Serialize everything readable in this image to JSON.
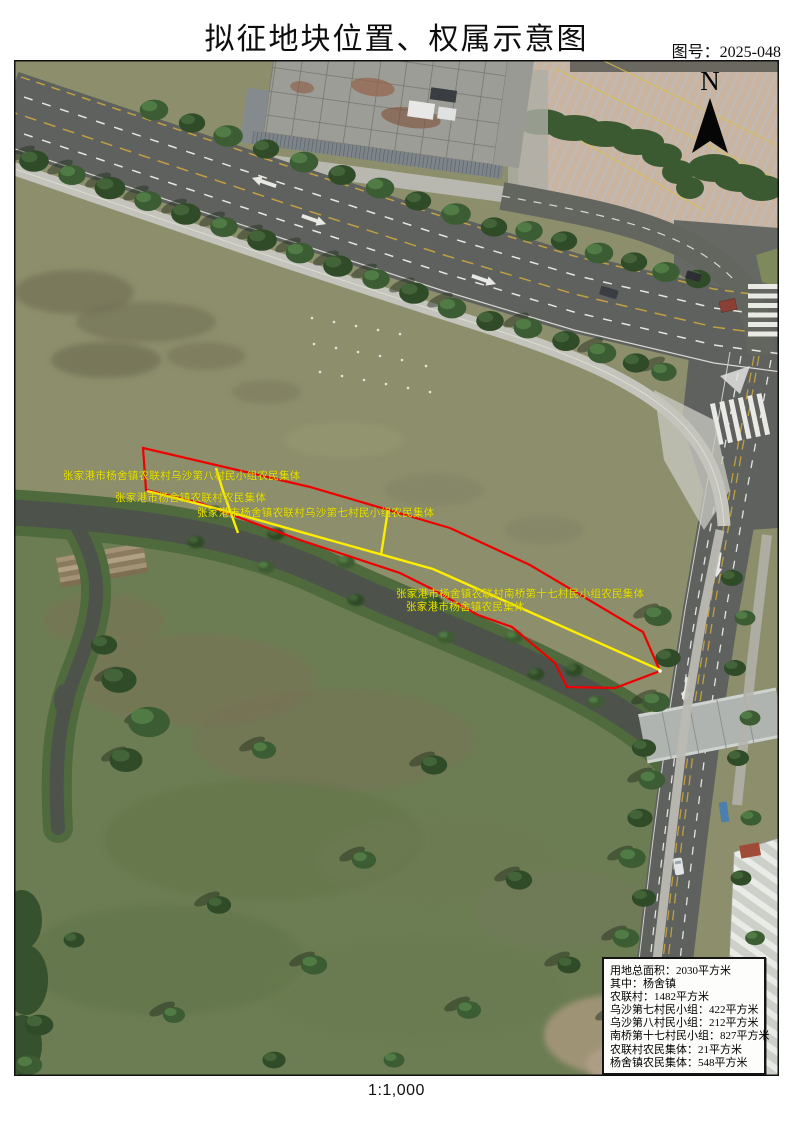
{
  "header": {
    "title": "拟征地块位置、权属示意图",
    "figure_no": "图号：2025-048"
  },
  "map": {
    "north_label": "N",
    "colors": {
      "parcel_outline": "#ee0000",
      "division_line": "#ffee00",
      "label_text": "#e8e200"
    },
    "parcel_labels": [
      {
        "text": "张家港市杨舍镇农联村乌沙第八村民小组农民集体"
      },
      {
        "text": "张家港市杨舍镇农联村农民集体"
      },
      {
        "text": "张家港市杨舍镇农联村乌沙第七村民小组农民集体"
      },
      {
        "text": "张家港市杨舍镇农联村南桥第十七村民小组农民集体"
      },
      {
        "text": "张家港市杨舍镇农民集体"
      }
    ],
    "info_box": {
      "lines": [
        "用地总面积：2030平方米",
        "其中：杨舍镇",
        "农联村：1482平方米",
        "乌沙第七村民小组：422平方米",
        "乌沙第八村民小组：212平方米",
        "南桥第十七村民小组：827平方米",
        "农联村农民集体：21平方米",
        "杨舍镇农民集体：548平方米"
      ]
    }
  },
  "footer": {
    "scale": "1:1,000"
  }
}
